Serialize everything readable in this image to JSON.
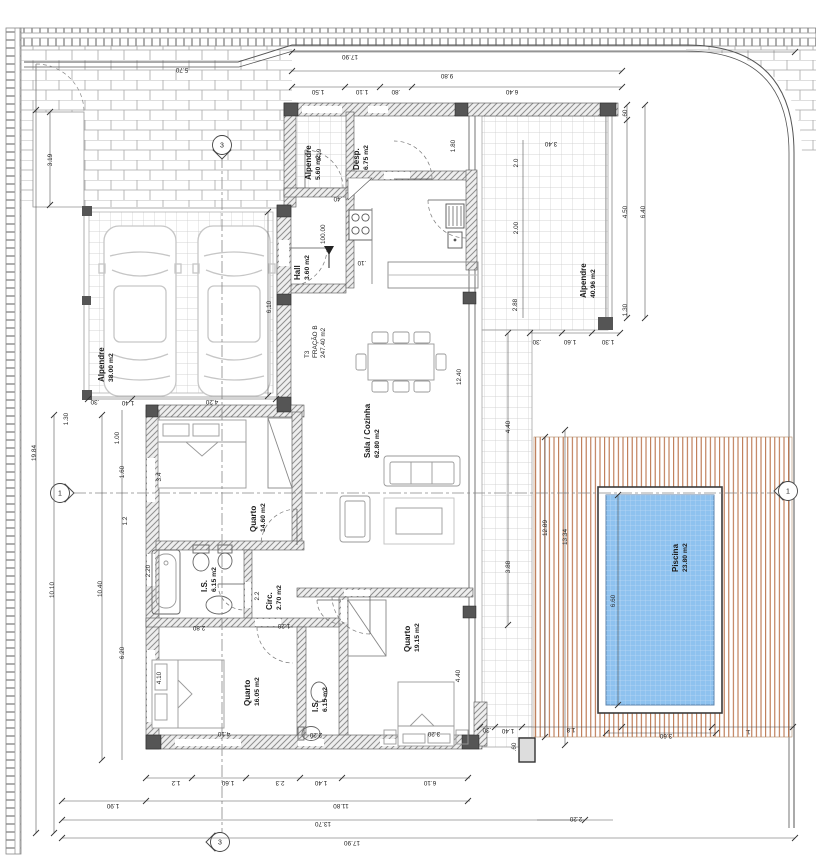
{
  "drawing": {
    "type": "architectural floor plan",
    "fraction_label": {
      "lines": [
        "T3",
        "FRAÇÃO B",
        "247.40 m2"
      ],
      "x": 309,
      "y": 358
    },
    "level_marker": {
      "text": "100.00",
      "x": 329,
      "y": 268
    },
    "rooms": [
      {
        "name": "Alpendre",
        "area": "5.60 m2",
        "x": 311,
        "y": 180
      },
      {
        "name": "Desp.",
        "area": "6.75 m2",
        "x": 359,
        "y": 170
      },
      {
        "name": "Hall",
        "area": "3.60 m2",
        "x": 300,
        "y": 280
      },
      {
        "name": "Alpendre",
        "area": "38.00 m2",
        "x": 104,
        "y": 382
      },
      {
        "name": "Sala / Cozinha",
        "area": "62.80 m2",
        "x": 370,
        "y": 458
      },
      {
        "name": "Quarto",
        "area": "14.60 m2",
        "x": 256,
        "y": 532
      },
      {
        "name": "I.S.",
        "area": "6.15 m2",
        "x": 207,
        "y": 592
      },
      {
        "name": "Circ.",
        "area": "2.70 m2",
        "x": 272,
        "y": 610
      },
      {
        "name": "Quarto",
        "area": "16.05 m2",
        "x": 250,
        "y": 706
      },
      {
        "name": "I.S.",
        "area": "6.15 m2",
        "x": 318,
        "y": 712
      },
      {
        "name": "Quarto",
        "area": "19.15 m2",
        "x": 410,
        "y": 652
      },
      {
        "name": "Alpendre",
        "area": "40.96 m2",
        "x": 586,
        "y": 298
      },
      {
        "name": "Piscina",
        "area": "23.80 m2",
        "x": 678,
        "y": 572
      }
    ],
    "section_markers": [
      {
        "n": "1",
        "x": 60,
        "y": 493,
        "dir": "right"
      },
      {
        "n": "1",
        "x": 788,
        "y": 491,
        "dir": "left"
      },
      {
        "n": "3",
        "x": 222,
        "y": 145,
        "dir": "down"
      },
      {
        "n": "3",
        "x": 220,
        "y": 842,
        "dir": "left"
      }
    ],
    "dimensions": [
      [
        "17.90",
        350,
        55,
        180
      ],
      [
        "9.80",
        447,
        74,
        180
      ],
      [
        "1.50",
        318,
        90,
        180
      ],
      [
        "1.10",
        362,
        90,
        180
      ],
      [
        ".80",
        396,
        90,
        180
      ],
      [
        "6.40",
        512,
        90,
        180
      ],
      [
        "5.70",
        182,
        68,
        180
      ],
      [
        "3.19",
        52,
        160,
        -90
      ],
      [
        ".60",
        627,
        114,
        -90
      ],
      [
        "4.50",
        627,
        212,
        -90
      ],
      [
        "1.30",
        627,
        310,
        -90
      ],
      [
        "6.40",
        645,
        212,
        -90
      ],
      [
        "3.40",
        551,
        142,
        180
      ],
      [
        "2.0",
        518,
        163,
        -90
      ],
      [
        "2.00",
        518,
        228,
        -90
      ],
      [
        "2.88",
        517,
        305,
        -90
      ],
      [
        ".30",
        537,
        340,
        180
      ],
      [
        "1.60",
        570,
        340,
        180
      ],
      [
        "1.30",
        608,
        340,
        180
      ],
      [
        "3.19",
        321,
        155,
        -90
      ],
      [
        "1.80",
        455,
        146,
        -90
      ],
      [
        ".40",
        338,
        197,
        180
      ],
      [
        ".10",
        362,
        261,
        180
      ],
      [
        "6.10",
        271,
        307,
        -90
      ],
      [
        "4.20",
        212,
        400,
        180
      ],
      [
        "1.40",
        128,
        401,
        180
      ],
      [
        ".30",
        95,
        400,
        180
      ],
      [
        "19.84",
        36,
        453,
        -90
      ],
      [
        "10.10",
        54,
        590,
        -90
      ],
      [
        "10.40",
        102,
        589,
        -90
      ],
      [
        "1.30",
        68,
        419,
        -90
      ],
      [
        "1.00",
        119,
        438,
        -90
      ],
      [
        "1.60",
        124,
        472,
        -90
      ],
      [
        "1.2",
        127,
        521,
        -90
      ],
      [
        "6.20",
        124,
        653,
        -90
      ],
      [
        "3.4",
        161,
        477,
        -90
      ],
      [
        "4.10",
        161,
        678,
        -90
      ],
      [
        "2.20",
        150,
        571,
        -90
      ],
      [
        "2.2",
        259,
        596,
        -90
      ],
      [
        "2.80",
        199,
        626,
        180
      ],
      [
        "1.20",
        284,
        624,
        180
      ],
      [
        "4.10",
        224,
        732,
        180
      ],
      [
        "2.20",
        316,
        733,
        180
      ],
      [
        "3.20",
        434,
        732,
        180
      ],
      [
        "4.40",
        460,
        676,
        -90
      ],
      [
        "12.40",
        461,
        377,
        -90
      ],
      [
        "3.88",
        510,
        567,
        -90
      ],
      [
        "4.40",
        510,
        427,
        -90
      ],
      [
        "12.89",
        547,
        528,
        -90
      ],
      [
        "13.34",
        567,
        537,
        -90
      ],
      [
        "6.60",
        615,
        601,
        -90
      ],
      [
        "3.60",
        666,
        734,
        180
      ],
      [
        "1.8",
        571,
        728,
        180
      ],
      [
        "1.40",
        508,
        729,
        180
      ],
      [
        ".30",
        487,
        728,
        180
      ],
      [
        "1.",
        748,
        730,
        180
      ],
      [
        ".60",
        516,
        747,
        -90
      ],
      [
        "2.20",
        576,
        817,
        180
      ],
      [
        "1.2",
        176,
        781,
        180
      ],
      [
        "1.60",
        228,
        781,
        180
      ],
      [
        "2.3",
        280,
        781,
        180
      ],
      [
        "1.40",
        321,
        781,
        180
      ],
      [
        "6.10",
        430,
        781,
        180
      ],
      [
        "1.90",
        113,
        804,
        180
      ],
      [
        "11.80",
        341,
        804,
        180
      ],
      [
        "13.70",
        323,
        822,
        180
      ],
      [
        "17.90",
        352,
        841,
        180
      ]
    ]
  },
  "colors": {
    "pool_water": "#8ec2ef",
    "deck_wood": "#b5673c",
    "wall_hatch": "#8f8f8f",
    "column_dark": "#555555"
  }
}
